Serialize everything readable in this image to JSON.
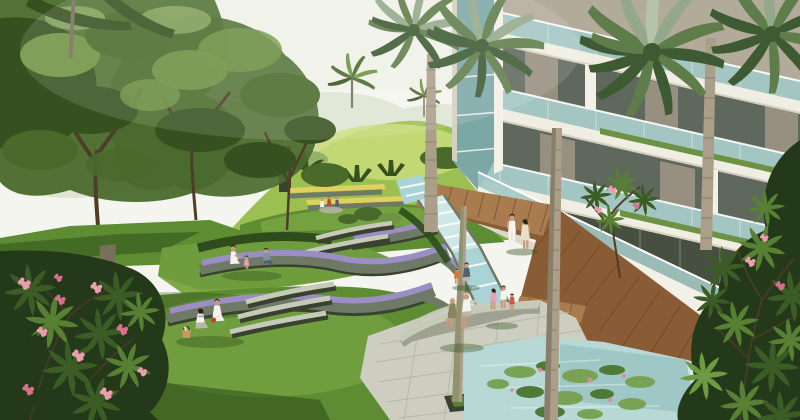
{
  "meta": {
    "width": "800",
    "height": "420",
    "kind": "architectural-landscape-rendering"
  },
  "palette": {
    "sky": "#f4f5ef",
    "haze": "#cfd8bd",
    "hill_light": "#c9dc78",
    "hill_mid": "#9cbf52",
    "hill_dark": "#7da23f",
    "canopy_dark": "#36511f",
    "canopy_mid": "#4a6a2c",
    "canopy_light": "#6f9343",
    "canopy_pale": "#96b268",
    "lawn_light": "#7fab47",
    "lawn_mid": "#5d8c33",
    "lawn_dark": "#3c611f",
    "shadow_green": "#2c4a17",
    "hedge": "#2f4c1d",
    "granite": "#6f7a66",
    "granite_dark": "#39422f",
    "bench_top": "#c6cab8",
    "flower_purple": "#9a8ec2",
    "flower_yellow": "#e0d060",
    "flower_pink": "#ee9cb0",
    "flower_pink_deep": "#d76f8d",
    "building_wall": "#b3ab9a",
    "building_taupe": "#978f7f",
    "slab_white": "#f0eee2",
    "slab_shadow": "#d4d0bf",
    "glass_teal": "#a3c6c3",
    "glass_teal_dark": "#7ba7a5",
    "recess_dark": "#5f685c",
    "glass_ground": "#474f41",
    "planter_green": "#6d9246",
    "wall_white": "#f2f0e7",
    "wall_shadow": "#dcd8c8",
    "board_light": "#a97c4f",
    "board_mid": "#8a5c36",
    "board_dark": "#6b4525",
    "plank_line": "#5e3c20",
    "water_light": "#cfe7e6",
    "water_mid": "#a9d3d4",
    "foam": "#ffffff",
    "pond": "#b7d8d5",
    "pond_deep": "#8fbcbc",
    "lilypad": "#79a254",
    "lilypad_dark": "#4f7a35",
    "lotus_pink": "#e289a0",
    "plaza_tile": "#cdcebf",
    "plaza_line": "#b2b3a4",
    "plaza_shadow": "#9fa191",
    "trunk_light": "#ab9f89",
    "trunk_dark": "#79705c",
    "trunk_ring": "#8d8370",
    "moss": "#7e8a5f",
    "frond_dark": "#3d5a33",
    "frond_mid": "#5f7d4b",
    "frond_light": "#93a98a",
    "frond_pale": "#b5c4a8",
    "fg_dark": "#24381a",
    "fg_mid": "#3c5c26",
    "fg_light": "#578033",
    "fg_pale": "#6f9a42",
    "branch": "#4e3d28",
    "skin": "#c79b7d",
    "hair": "#2a2118",
    "white_hair": "#dcd8cc",
    "cloth_white": "#f4f2ea",
    "cloth_cream": "#e9dfc8",
    "cloth_blue": "#7e90a8",
    "cloth_slate": "#55606e",
    "cloth_olive": "#8a855f",
    "cloth_orange": "#d9782e",
    "cloth_red": "#c24334",
    "cloth_pink": "#e8a0b4",
    "basket_tan": "#c49a5e",
    "cloth_gray": "#b9b7ac"
  },
  "scene": {
    "elements": [
      "pale-sky",
      "hazy-tree-line",
      "grassy-hill-with-palms",
      "large-shade-trees-left",
      "terraced-lawns",
      "granite-planter-walls-with-purple-flowers",
      "yellow-flower-beds",
      "curved-concrete-bench-steps",
      "condominium-facade-with-teal-glass-balconies",
      "balcony-planter-strips",
      "fan-palm-trees",
      "wooden-boardwalk",
      "cascading-stream",
      "stone-plaza-with-curved-bench",
      "lily-pond-with-lotus",
      "infinity-edge-waterfall",
      "frangipani-bush-pink-flowers-foreground-left",
      "foliage-foreground-right",
      "people-picnicking",
      "family-with-child",
      "couple-walking",
      "elderly-couple-seated",
      "children-seated"
    ]
  }
}
